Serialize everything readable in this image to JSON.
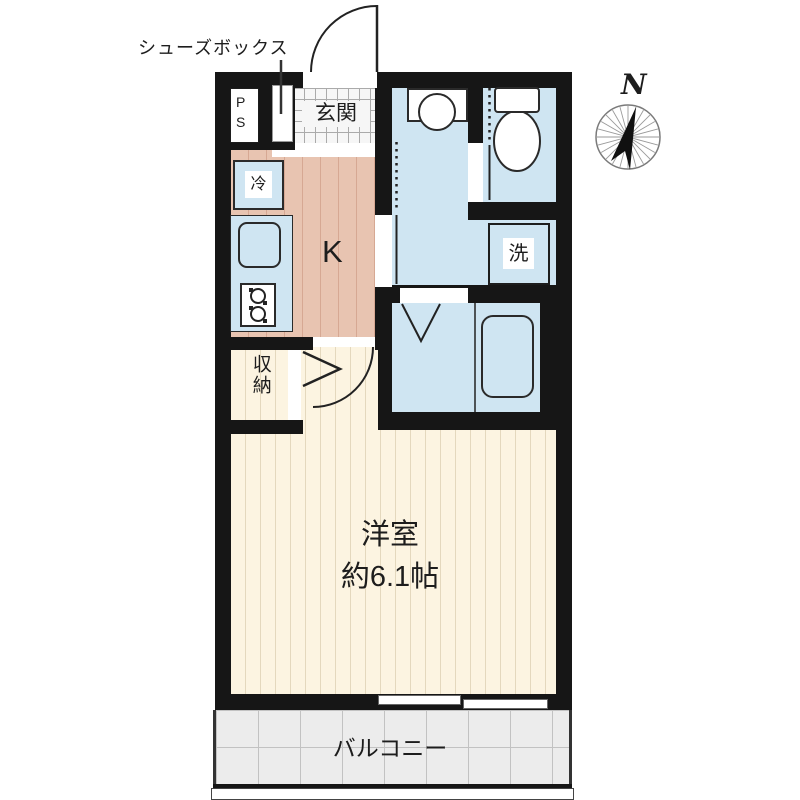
{
  "plan": {
    "shoe_box_label": "シューズボックス",
    "pipe_space_label": "P\nS",
    "entrance_label": "玄関",
    "refrigerator_label": "冷",
    "kitchen_label": "K",
    "washer_label": "洗",
    "storage_label": "収納",
    "room_name_label": "洋室",
    "room_size_label": "約6.1帖",
    "balcony_label": "バルコニー",
    "compass_north_label": "N"
  },
  "colors": {
    "wall": "#161616",
    "floor-cream": "#fcf4e1",
    "floor-cream-stripe": "#e4d8bd",
    "floor-pink": "#e8c4b1",
    "floor-pink-stripe": "#d6a893",
    "wet-blue": "#cfe5f2",
    "tile-white": "#f6f6f6",
    "tile-line": "#aaaaaa",
    "balcony-gray": "#ececec",
    "balcony-line": "#c2c2c2",
    "line-dark": "#222222"
  }
}
